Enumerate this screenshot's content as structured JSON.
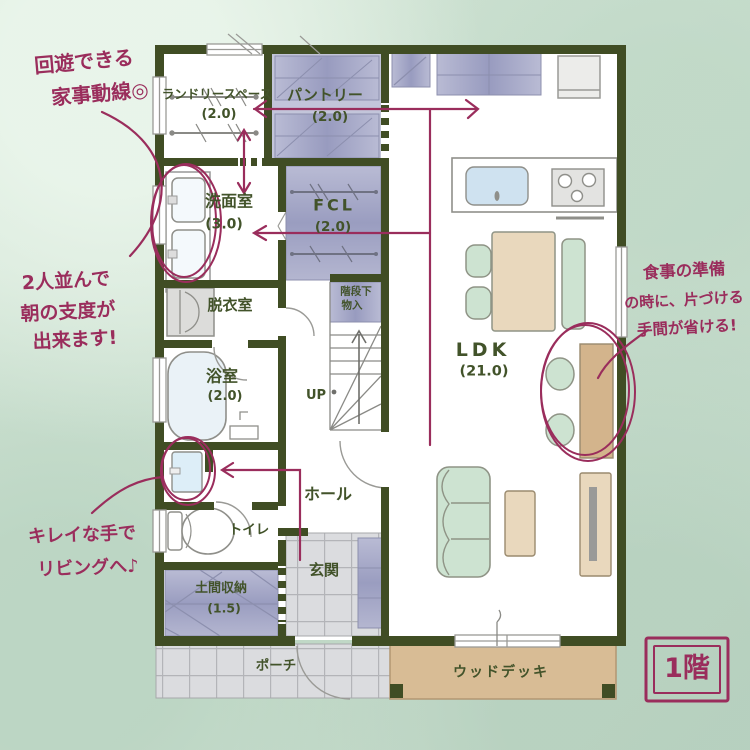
{
  "floor_badge": "1階",
  "rooms": {
    "laundry_space": {
      "label": "ランドリースペース",
      "area": "(2.0)"
    },
    "pantry": {
      "label": "パントリー",
      "area": "(2.0)"
    },
    "washroom": {
      "label": "洗面室",
      "area": "(3.0)"
    },
    "family_closet": {
      "label": "FCL",
      "area": "(2.0)"
    },
    "dressing_room": {
      "label": "脱衣室"
    },
    "bathroom": {
      "label": "浴室",
      "area": "(2.0)"
    },
    "under_stair_storage": {
      "line1": "階段下",
      "line2": "物入"
    },
    "stairs": {
      "label": "UP"
    },
    "hall": {
      "label": "ホール"
    },
    "toilet": {
      "label": "トイレ"
    },
    "entrance": {
      "label": "玄関"
    },
    "doma_storage": {
      "label": "土間収納",
      "area": "(1.5)"
    },
    "porch": {
      "label": "ポーチ"
    },
    "ldk": {
      "label": "LDK",
      "area": "(21.0)"
    },
    "wood_deck": {
      "label": "ウッドデッキ"
    }
  },
  "annotations": {
    "housework_flow": {
      "line1": "回遊できる",
      "line2": "家事動線◎"
    },
    "morning_prep": {
      "line1": "2人並んで",
      "line2": "朝の支度が",
      "line3": "出来ます!"
    },
    "clean_hands": {
      "line1": "キレイな手で",
      "line2": "リビングへ♪"
    },
    "meal_prep": {
      "line1": "食事の準備",
      "line2": "の時に、片づける",
      "line3": "手間が省ける!"
    }
  },
  "colors": {
    "wall": "#404d24",
    "annotation_pink": "#9a2d5c",
    "label_green": "#42532a",
    "closet_purple": "#a6a8c8",
    "wood_deck_tan": "#d8bc95",
    "background_sage": "#cfe2d3"
  }
}
